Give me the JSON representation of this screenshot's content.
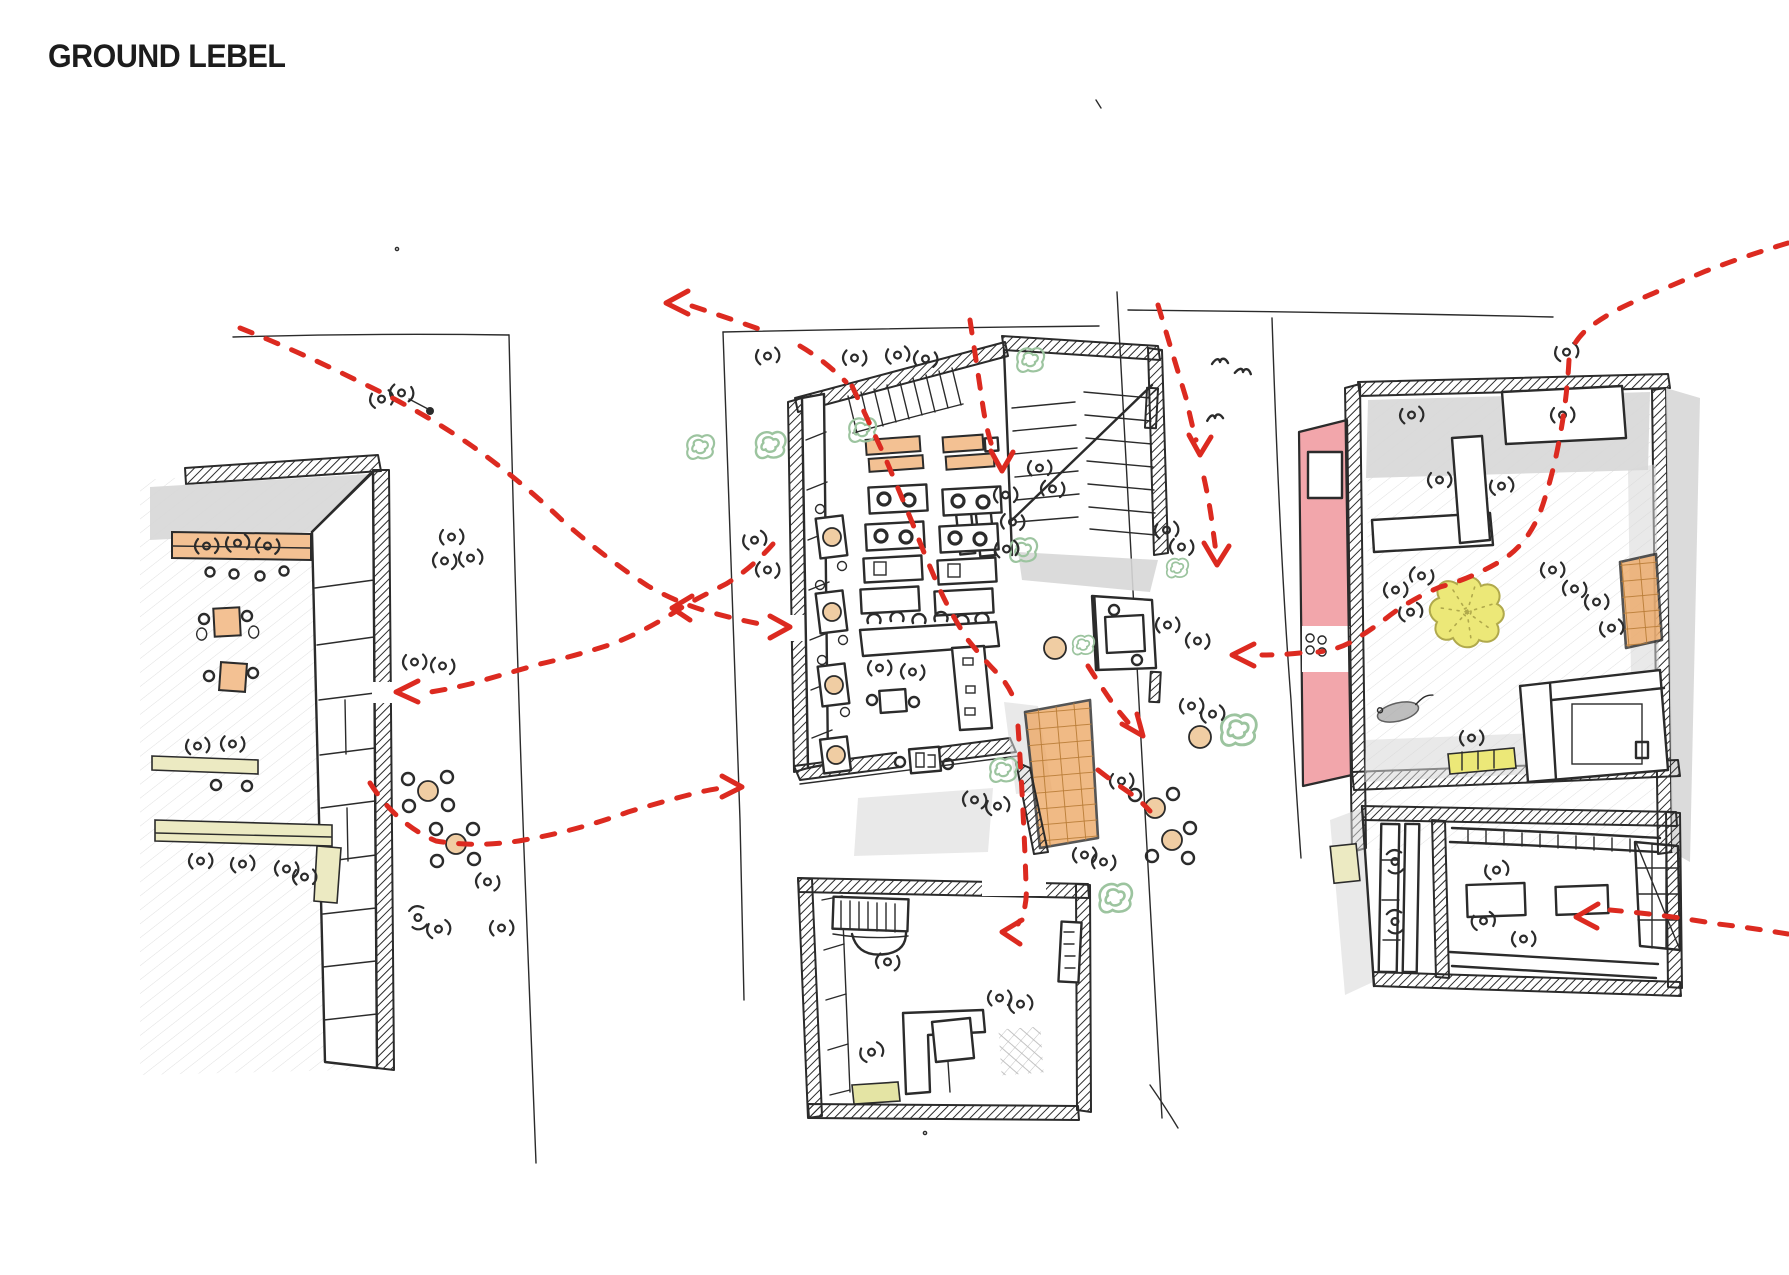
{
  "page": {
    "title": "GROUND LEBEL"
  },
  "palette": {
    "ink": "#2b2b2b",
    "paper": "#ffffff",
    "red": "#dc2a20",
    "pink": "#f2a6ab",
    "yellow": "#ece878",
    "ydark": "#b0a94c",
    "orange": "#eda967",
    "orangelight": "#f3c193",
    "tan": "#f0cda3",
    "cream": "#eceac2",
    "green": "#9cc49f",
    "grey": "#d7d7d7",
    "pencil": "#c7c7c7",
    "mat": "#e4e4a4",
    "rat": "#a9a9a9",
    "gridline": "#b97c36"
  },
  "icons": [
    "person-icon",
    "people-group-icon",
    "dog-icon",
    "bird-icon",
    "rat-icon",
    "shrub-icon",
    "tree-top-icon",
    "circulation-arrow-icon"
  ]
}
